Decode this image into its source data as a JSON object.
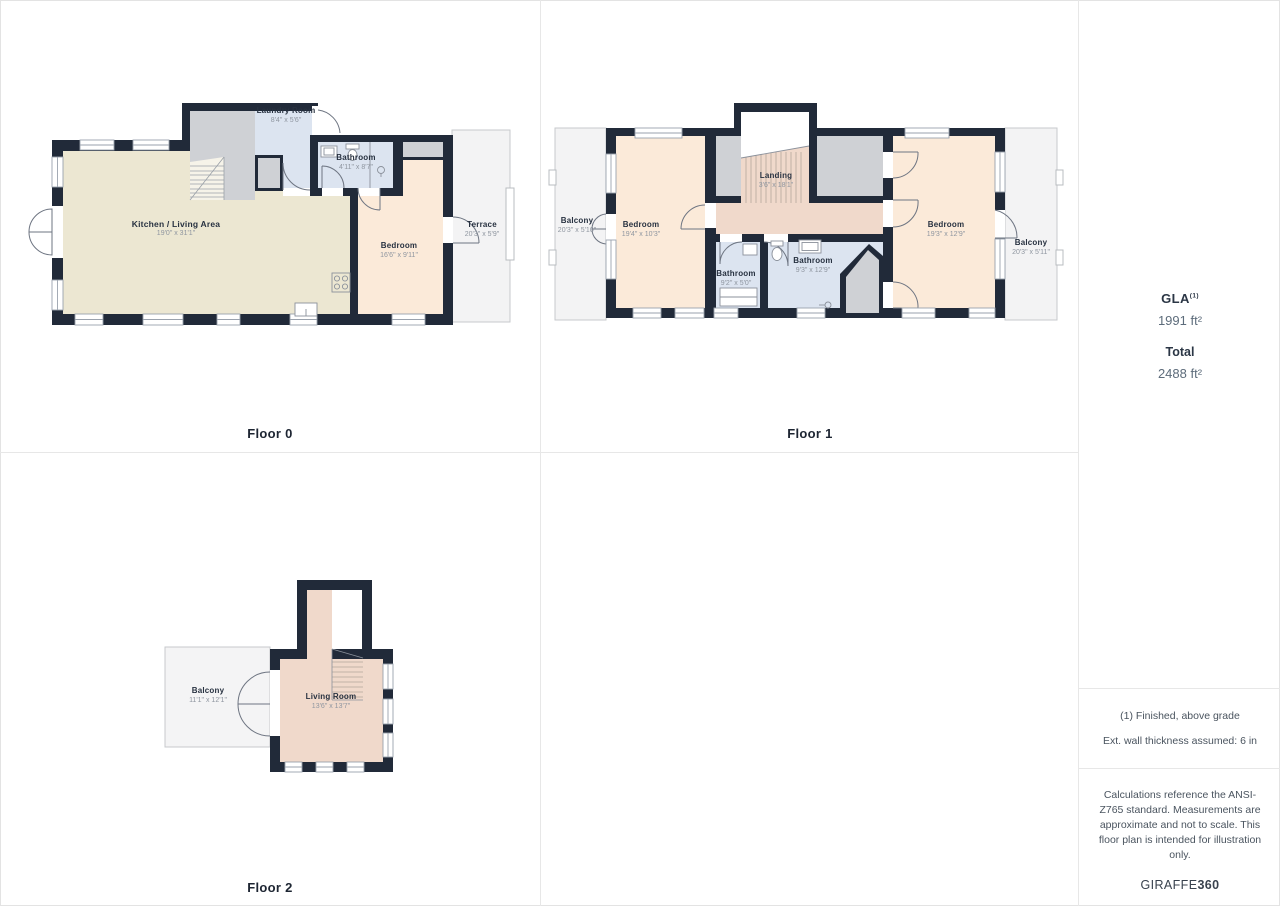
{
  "palette": {
    "wall": "#212a39",
    "kitchen_floor": "#ece7d2",
    "bedroom_floor": "#fbead9",
    "bathroom_floor": "#dce4f0",
    "stairs_landing_floor": "#f0d9cb",
    "utility_gray": "#cfd1d5",
    "outdoor_fill": "#f3f3f4",
    "label_text": "#273140",
    "dims_text": "#8f96a0",
    "value_text": "#5d6c7b"
  },
  "floor0": {
    "caption": "Floor 0",
    "rooms": {
      "laundry": {
        "name": "Laundry Room",
        "dims": "8'4\" x 5'6\""
      },
      "bathroom": {
        "name": "Bathroom",
        "dims": "4'11\" x 8'7\""
      },
      "kitchen": {
        "name": "Kitchen / Living Area",
        "dims": "19'0\" x 31'1\""
      },
      "bedroom": {
        "name": "Bedroom",
        "dims": "16'6\" x 9'11\""
      },
      "terrace": {
        "name": "Terrace",
        "dims": "20'3\" x 5'9\""
      }
    }
  },
  "floor1": {
    "caption": "Floor 1",
    "rooms": {
      "balcony_left": {
        "name": "Balcony",
        "dims": "20'3\" x 5'10\""
      },
      "bedroom_left": {
        "name": "Bedroom",
        "dims": "19'4\" x 10'3\""
      },
      "landing": {
        "name": "Landing",
        "dims": "3'6\" x 18'1\""
      },
      "bathroom_small": {
        "name": "Bathroom",
        "dims": "9'2\" x 5'0\""
      },
      "bathroom_large": {
        "name": "Bathroom",
        "dims": "9'3\" x 12'9\""
      },
      "bedroom_right": {
        "name": "Bedroom",
        "dims": "19'3\" x 12'9\""
      },
      "balcony_right": {
        "name": "Balcony",
        "dims": "20'3\" x 5'11\""
      }
    }
  },
  "floor2": {
    "caption": "Floor 2",
    "rooms": {
      "balcony": {
        "name": "Balcony",
        "dims": "11'1\" x 12'1\""
      },
      "living": {
        "name": "Living Room",
        "dims": "13'6\" x 13'7\""
      }
    }
  },
  "sidebar": {
    "gla_label": "GLA",
    "gla_note_ref": "(1)",
    "gla_value": "1991 ft²",
    "total_label": "Total",
    "total_value": "2488 ft²",
    "note_finished": "(1) Finished, above grade",
    "note_wall": "Ext. wall thickness assumed: 6 in",
    "disclaimer": "Calculations reference the ANSI-Z765 standard. Measurements are approximate and not to scale. This floor plan is intended for illustration only.",
    "brand_regular": "GIRAFFE",
    "brand_bold": "360"
  }
}
